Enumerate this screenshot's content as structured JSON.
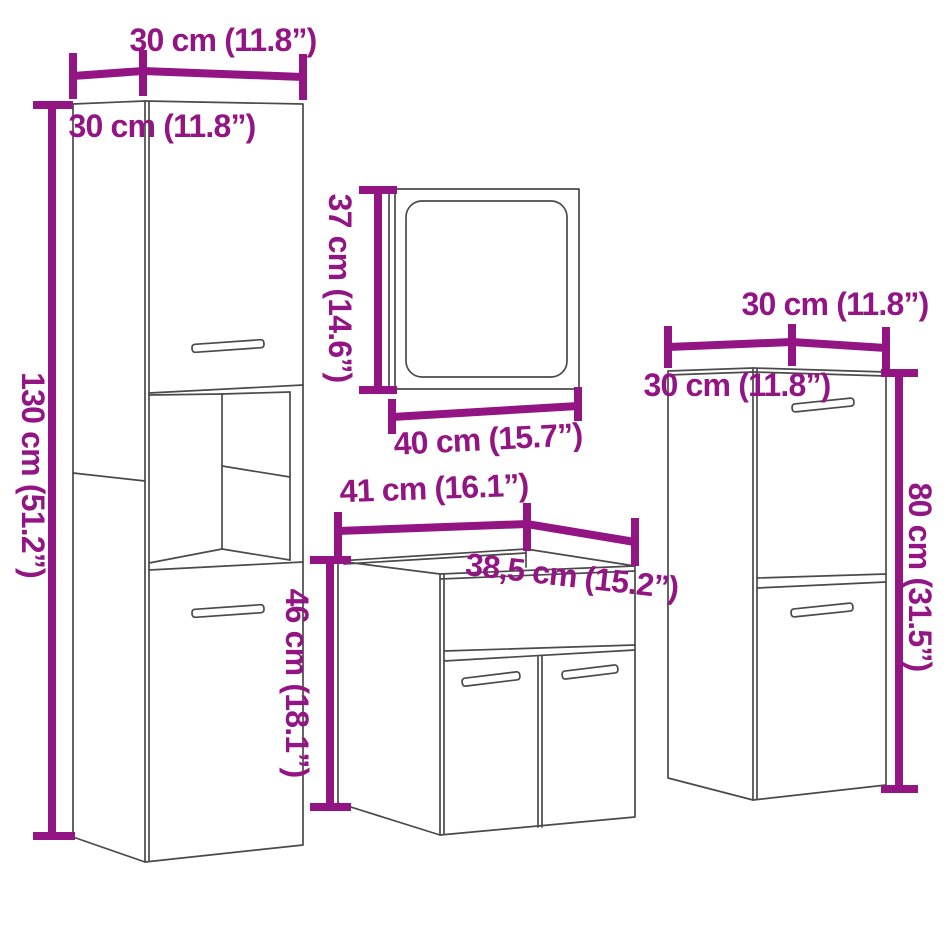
{
  "page": {
    "background": "#ffffff",
    "accent_color": "#921583",
    "line_color": "#4a4a4a",
    "units": "cm and inches"
  },
  "diagram": {
    "kind": "bathroom-furniture-set-dimension-diagram",
    "pieces": [
      {
        "id": "tall-cabinet",
        "labels": {
          "width": "30 cm (11.8”)",
          "depth": "30 cm (11.8”)",
          "height": "130 cm (51.2”)"
        }
      },
      {
        "id": "mirror",
        "labels": {
          "height": "37 cm (14.6”)",
          "width": "40 cm (15.7”)"
        }
      },
      {
        "id": "sink-cabinet",
        "labels": {
          "width": "41 cm (16.1”)",
          "depth": "38,5 cm (15.2”)",
          "height": "46 cm (18.1”)"
        }
      },
      {
        "id": "side-cabinet",
        "labels": {
          "width": "30 cm (11.8”)",
          "depth": "30 cm (11.8”)",
          "height": "80 cm (31.5”)"
        }
      }
    ]
  }
}
